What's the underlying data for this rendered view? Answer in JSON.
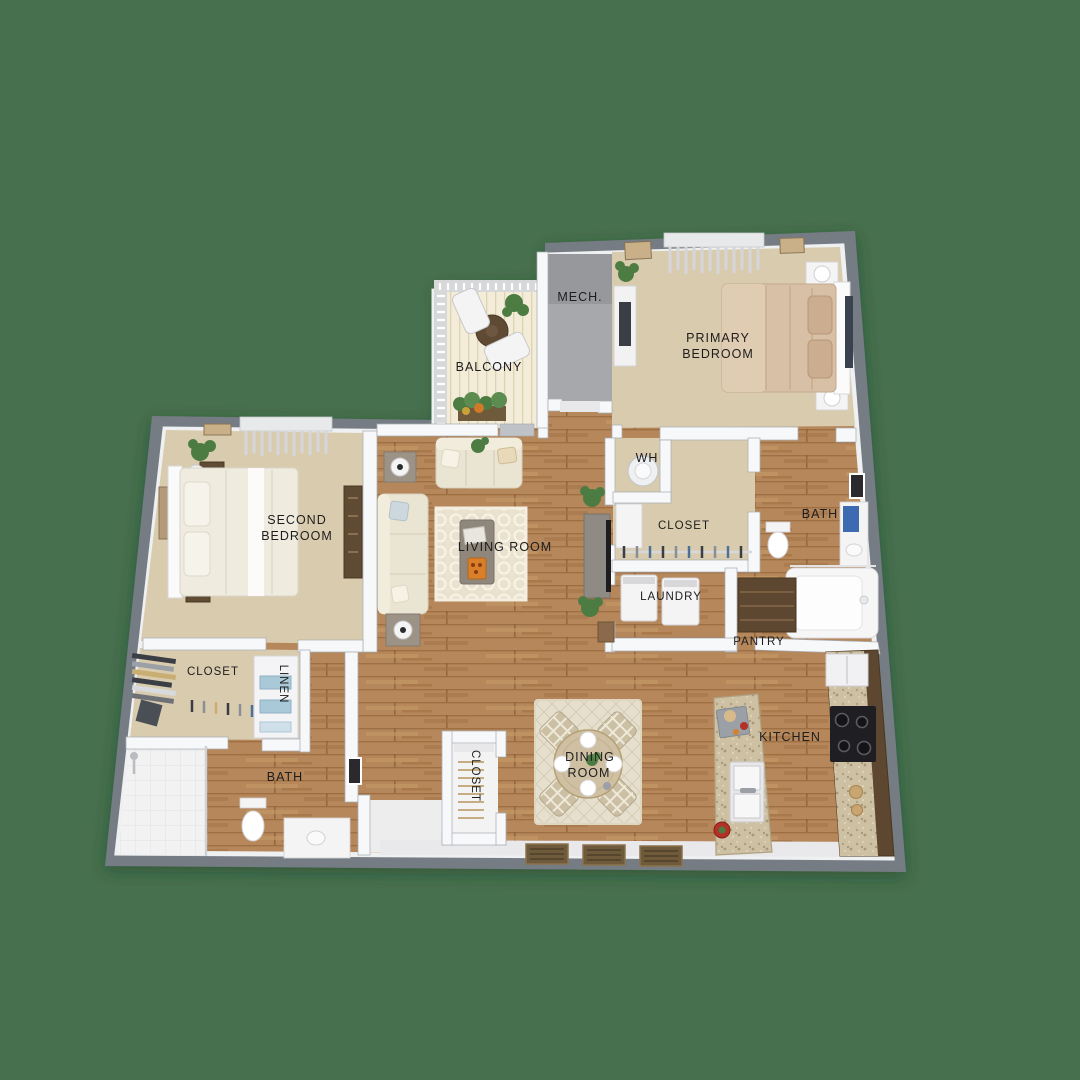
{
  "title": "apartment-floor-plan",
  "colors": {
    "background": "#47704e",
    "wall": "#757b83",
    "wall_inner": "#f7f8f9",
    "carpet": "#d9ccae",
    "wood": "#b5875a",
    "deck": "#f3ecd8",
    "mech_floor": "#a7a8ac",
    "rug": "#eae2cf",
    "rug_dining": "#e6dfcd",
    "sofa": "#eae4d3",
    "bed_primary": "#d8c0a6",
    "bed_second": "#efebdf",
    "cabinet": "#5d4730",
    "counter": "#cec0a3",
    "stove": "#1f1f23",
    "towel": "#3e6ab2",
    "linen": "#a9c8d8",
    "plant": "#4d7c43",
    "table_wood": "#cfc0a4",
    "mat": "#6f5a3c",
    "white_floor": "#f3f3f4",
    "label": "#1d1d1d",
    "tv": "#1d1d1f"
  },
  "rooms": {
    "mech": {
      "label": "MECH."
    },
    "balcony": {
      "label": "BALCONY"
    },
    "primary_bedroom": {
      "line1": "PRIMARY",
      "line2": "BEDROOM"
    },
    "second_bedroom": {
      "line1": "SECOND",
      "line2": "BEDROOM"
    },
    "living_room": {
      "label": "LIVING ROOM"
    },
    "water_heater": {
      "label": "WH"
    },
    "primary_closet": {
      "label": "CLOSET"
    },
    "primary_bath": {
      "label": "BATH"
    },
    "laundry": {
      "label": "LAUNDRY"
    },
    "pantry": {
      "label": "PANTRY"
    },
    "second_closet": {
      "label": "CLOSET"
    },
    "linen": {
      "label": "LINEN"
    },
    "second_bath": {
      "label": "BATH"
    },
    "hall_closet": {
      "label": "CLOSET"
    },
    "dining_room": {
      "line1": "DINING",
      "line2": "ROOM"
    },
    "kitchen": {
      "label": "KITCHEN"
    }
  }
}
